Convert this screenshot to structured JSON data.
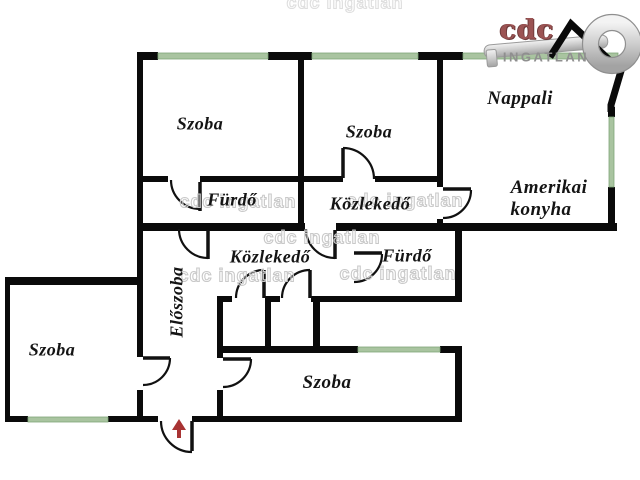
{
  "image_type": "apartment floor plan",
  "rooms": {
    "szoba_top_left": "Szoba",
    "szoba_top_mid": "Szoba",
    "nappali": "Nappali",
    "amerikai_line1": "Amerikai",
    "amerikai_line2": "konyha",
    "furdo_upper": "Fürdő",
    "kozlekedo_upper": "Közlekedő",
    "kozlekedo_lower": "Közlekedő",
    "furdo_lower": "Fürdő",
    "eloszoba": "Előszoba",
    "szoba_bottom_left": "Szoba",
    "szoba_bottom_mid": "Szoba"
  },
  "logo": {
    "brand": "cdc",
    "name": "INGATLAN"
  },
  "watermark_text": "cdc ingatlan",
  "colors": {
    "wall": "#0a0a0a",
    "window_green": "#a9c4a0",
    "window_edge": "#7fa579",
    "entrance_arrow_red": "#a83333",
    "logo_red": "#9b5353",
    "logo_gray": "#8f8f8f",
    "watermark_gray": "#c9c9c9",
    "key_silver": "#c9c9c9"
  }
}
